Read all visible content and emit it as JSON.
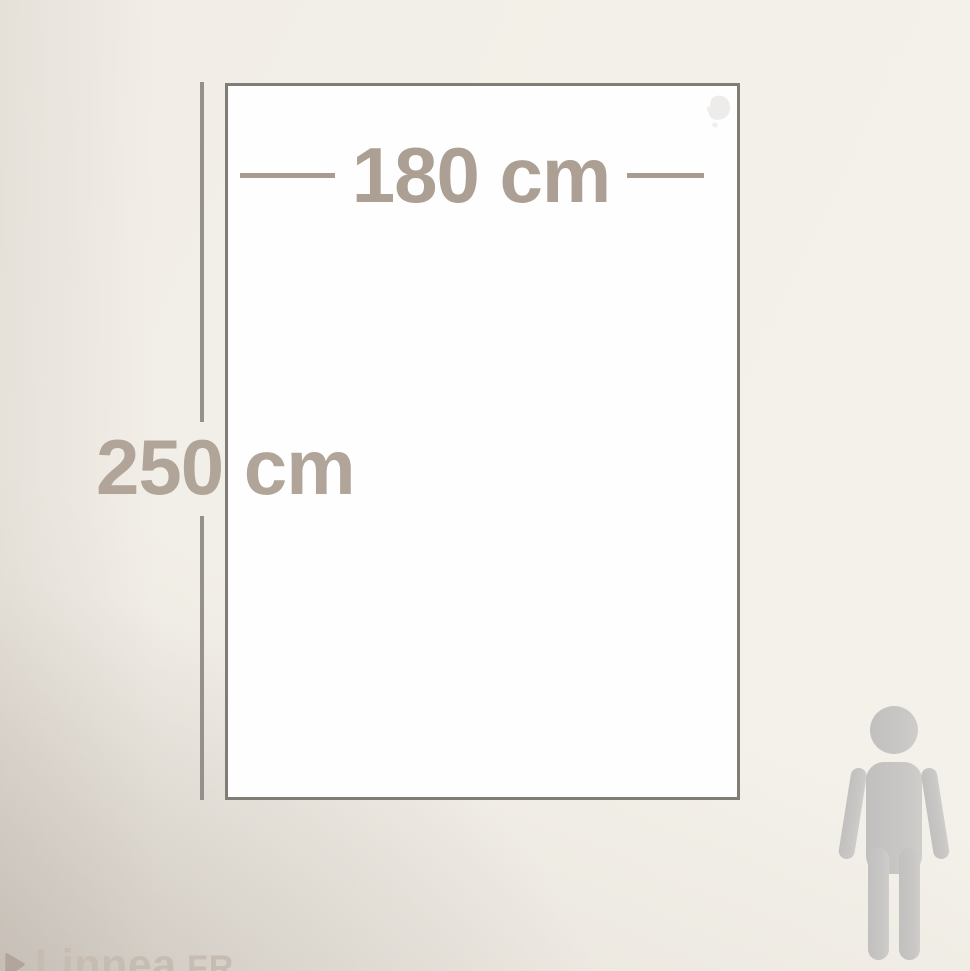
{
  "diagram": {
    "width_label": "180 cm",
    "height_label": "250 cm"
  },
  "watermark": {
    "brand": "Linnea",
    "tld": ".FR"
  },
  "icons": {
    "person": "person-silhouette",
    "brand_arrow": "play-arrow",
    "corner_mark": "leaf-logo-watermark"
  },
  "colors": {
    "dimension_text": "#ac9f93",
    "dimension_line": "#a89b8f",
    "rect_border": "#7f7d76",
    "rect_fill": "#fefefe",
    "person": "#c7c6c3",
    "watermark_text": "#c7bcb2",
    "background_light": "#f4f1ea",
    "background_dark": "#d3cbc3"
  }
}
